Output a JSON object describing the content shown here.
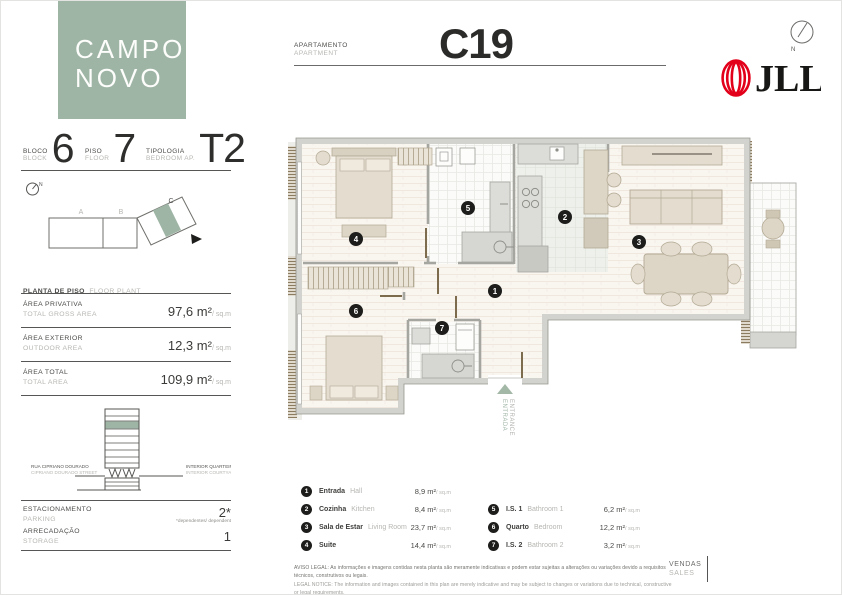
{
  "brand": {
    "logo_line1": "CAMPO",
    "logo_line2": "NOVO",
    "jll": "JLL",
    "north_letter": "N"
  },
  "header": {
    "apartment_label_pt": "APARTAMENTO",
    "apartment_label_en": "APARTMENT",
    "unit": "C19"
  },
  "sidebar": {
    "stats": [
      {
        "label_pt": "BLOCO",
        "label_en": "BLOCK",
        "value": "6"
      },
      {
        "label_pt": "PISO",
        "label_en": "FLOOR",
        "value": "7"
      },
      {
        "label_pt": "TIPOLOGIA",
        "label_en": "BEDROOM AP.",
        "value": "T2"
      }
    ],
    "key_plan": {
      "block_a": "A",
      "block_b": "B",
      "block_c": "C"
    },
    "floor_plan_label_pt": "PLANTA DE PISO",
    "floor_plan_label_en": "FLOOR PLANT",
    "areas": [
      {
        "pt": "ÁREA PRIVATIVA",
        "en": "TOTAL GROSS AREA",
        "value": "97,6 m²",
        "per": "/ sq.m"
      },
      {
        "pt": "ÁREA EXTERIOR",
        "en": "OUTDOOR AREA",
        "value": "12,3 m²",
        "per": "/ sq.m"
      },
      {
        "pt": "ÁREA TOTAL",
        "en": "TOTAL AREA",
        "value": "109,9 m²",
        "per": "/ sq.m"
      }
    ],
    "section": {
      "street_pt": "RUA CIPRIANO DOURADO",
      "street_en": "CIPRIANO DOURADO STREET",
      "courtyard_pt": "INTERIOR QUARTEIRÃO",
      "courtyard_en": "INTERIOR COURTYARD"
    },
    "facilities": [
      {
        "pt": "ESTACIONAMENTO",
        "en": "PARKING",
        "value": "2*",
        "note": "*dependentes/ dependent"
      },
      {
        "pt": "ARRECADAÇÃO",
        "en": "STORAGE",
        "value": "1",
        "note": ""
      }
    ]
  },
  "plan": {
    "markers": [
      "1",
      "2",
      "3",
      "4",
      "5",
      "6",
      "7"
    ],
    "entrance_pt": "ENTRADA",
    "entrance_en": "ENTRANCE"
  },
  "legend": {
    "items": [
      {
        "n": "1",
        "pt": "Entrada",
        "en": "Hall",
        "area": "8,9 m²",
        "per": "/ sq.m"
      },
      {
        "n": "2",
        "pt": "Cozinha",
        "en": "Kitchen",
        "area": "8,4 m²",
        "per": "/ sq.m"
      },
      {
        "n": "3",
        "pt": "Sala de Estar",
        "en": "Living Room",
        "area": "23,7 m²",
        "per": "/ sq.m"
      },
      {
        "n": "4",
        "pt": "Suite",
        "en": "",
        "area": "14,4 m²",
        "per": "/ sq.m"
      },
      {
        "n": "5",
        "pt": "I.S. 1",
        "en": "Bathroom 1",
        "area": "6,2 m²",
        "per": "/ sq.m"
      },
      {
        "n": "6",
        "pt": "Quarto",
        "en": "Bedroom",
        "area": "12,2 m²",
        "per": "/ sq.m"
      },
      {
        "n": "7",
        "pt": "I.S. 2",
        "en": "Bathroom 2",
        "area": "3,2 m²",
        "per": "/ sq.m"
      }
    ]
  },
  "footer": {
    "legal_pt": "AVISO LEGAL: As informações e imagens contidas nesta planta são meramente indicativas e podem estar sujeitas a alterações ou variações devido a requisitos técnicos, construtivos ou legais.",
    "legal_en": "LEGAL NOTICE: The information and images contained in this plan are merely indicative and may be subject to changes or variations due to technical, constructive or legal requirements.",
    "sales_pt": "VENDAS",
    "sales_en": "SALES"
  },
  "colors": {
    "accent": "#9eb5a5",
    "jll_red": "#e2001a",
    "ink": "#3b3b39",
    "muted": "#b6b6b2"
  }
}
